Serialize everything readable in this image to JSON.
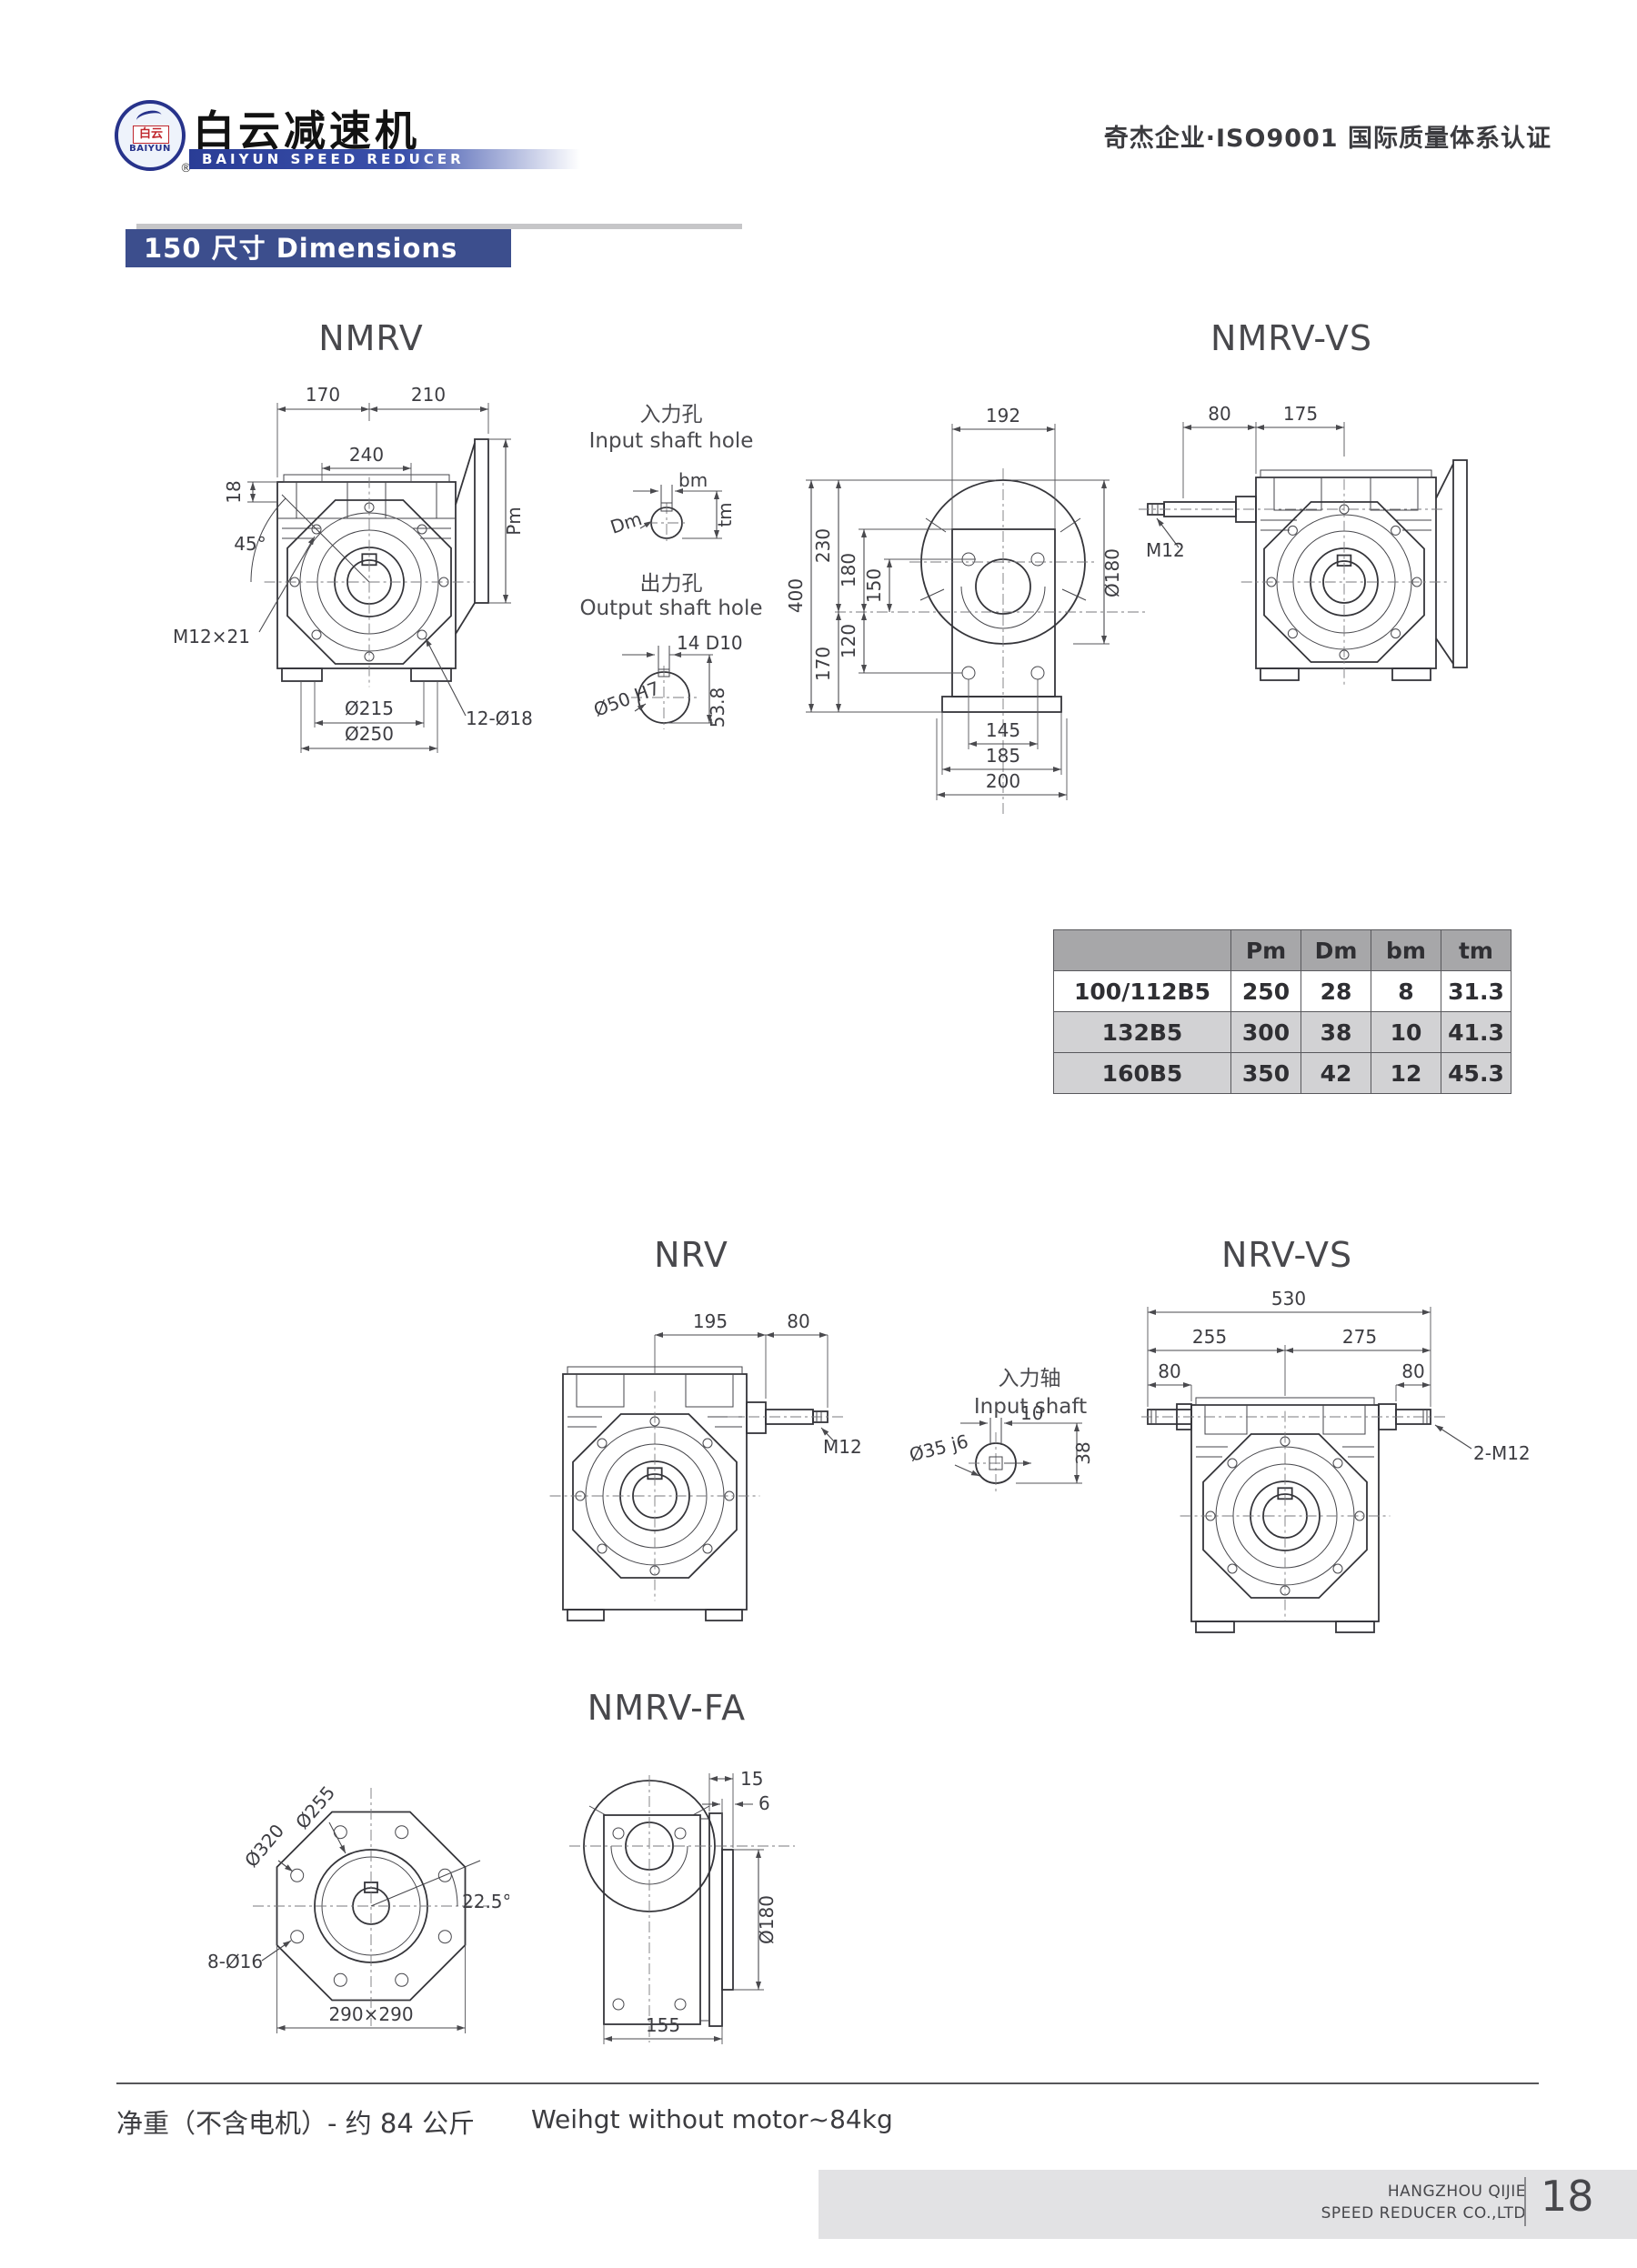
{
  "header": {
    "emblem_cn": "白云",
    "emblem_en": "BAIYUN",
    "registered_mark": "®",
    "brand_cn": "白云减速机",
    "brand_en": "BAIYUN SPEED REDUCER",
    "certification": "奇杰企业·ISO9001 国际质量体系认证"
  },
  "title_bar": {
    "text": "150 尺寸 Dimensions"
  },
  "drawings": {
    "nmrv": {
      "title": "NMRV",
      "top_left": "170",
      "top_right": "210",
      "lug_span": "240",
      "plate": "18",
      "angle": "45°",
      "tap": "M12×21",
      "pcd": "Ø215",
      "bolts": "12-Ø18",
      "flange_od": "Ø250",
      "pm": "Pm"
    },
    "input_hole": {
      "title_cn": "入力孔",
      "title_en": "Input shaft hole",
      "bm": "bm",
      "dm": "Dm",
      "tm": "tm"
    },
    "output_hole": {
      "title_cn": "出力孔",
      "title_en": "Output shaft hole",
      "key": "14 D10",
      "bore": "Ø50 H7",
      "depth": "53.8"
    },
    "front": {
      "width": "192",
      "height": "400",
      "h230": "230",
      "h180": "180",
      "h150": "150",
      "h120": "120",
      "h170": "170",
      "dia": "Ø180",
      "b145": "145",
      "b185": "185",
      "b200": "200"
    },
    "nmrv_vs": {
      "title": "NMRV-VS",
      "d80": "80",
      "d175": "175",
      "m12": "M12"
    },
    "nrv": {
      "title": "NRV",
      "d195": "195",
      "d80": "80",
      "m12": "M12"
    },
    "input_shaft": {
      "title_cn": "入力轴",
      "title_en": "Input shaft",
      "key_w": "10",
      "dia": "Ø35 j6",
      "h": "38"
    },
    "nrv_vs": {
      "title": "NRV-VS",
      "total": "530",
      "left": "255",
      "right": "275",
      "d80_left": "80",
      "d80_right": "80",
      "m12": "2-M12"
    },
    "nmrv_fa": {
      "title": "NMRV-FA",
      "dia255": "Ø255",
      "dia320": "Ø320",
      "angle": "22.5°",
      "bolts": "8-Ø16",
      "square": "290×290",
      "d15": "15",
      "d6": "6",
      "dia180": "Ø180",
      "d155": "155"
    }
  },
  "spec_table": {
    "col_headers": [
      "Pm",
      "Dm",
      "bm",
      "tm"
    ],
    "rows": [
      {
        "model": "100/112B5",
        "pm": "250",
        "dm": "28",
        "bm": "8",
        "tm": "31.3"
      },
      {
        "model": "132B5",
        "pm": "300",
        "dm": "38",
        "bm": "10",
        "tm": "41.3"
      },
      {
        "model": "160B5",
        "pm": "350",
        "dm": "42",
        "bm": "12",
        "tm": "45.3"
      }
    ]
  },
  "footer": {
    "weight_cn": "净重（不含电机）- 约 84 公斤",
    "weight_en": "Weihgt without motor~84kg",
    "company_line1": "HANGZHOU QIJIE",
    "company_line2": "SPEED REDUCER CO.,LTD",
    "page_number": "18"
  },
  "colors": {
    "accent_blue": "#3c4e8d",
    "table_header_bg": "#a7a7a9",
    "table_row_alt": "#d2d2d4"
  }
}
